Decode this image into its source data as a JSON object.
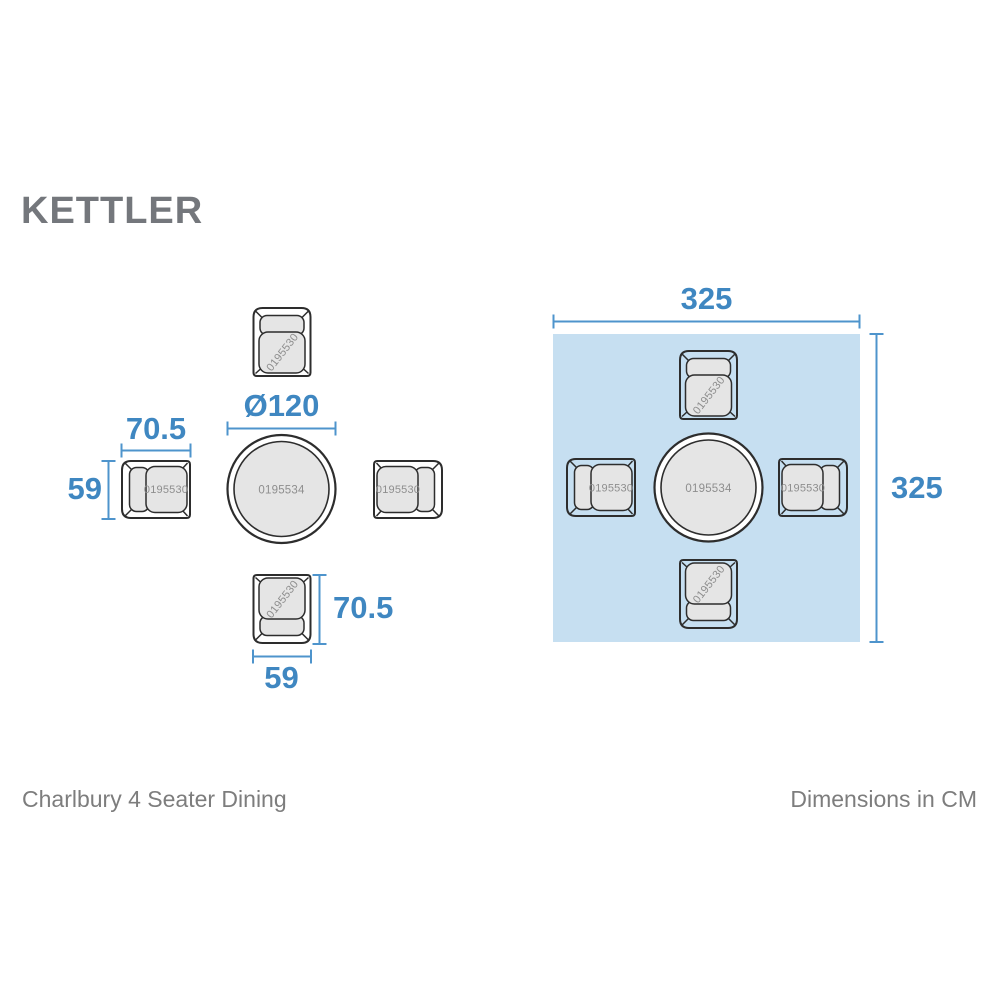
{
  "page": {
    "brand_logo": "KETTLER",
    "product_name": "Charlbury 4 Seater Dining",
    "units_note": "Dimensions in CM"
  },
  "sku": {
    "chair": "0195530",
    "table": "0195534"
  },
  "exploded_view": {
    "table_diameter_label": "Ø120",
    "chair_depth_label": "70.5",
    "chair_width_label": "59"
  },
  "footprint_view": {
    "width_label": "325",
    "height_label": "325"
  },
  "colors": {
    "accent_blue_text": "#3f87c1",
    "accent_blue_line": "#4e94cc",
    "footprint_fill": "#c6dff1",
    "furniture_outline": "#2d2d2d",
    "cushion_fill": "#e5e5e5",
    "sku_text": "#8e8e8e",
    "caption_text": "#7d7d7d",
    "logo_gray": "#74777c"
  }
}
